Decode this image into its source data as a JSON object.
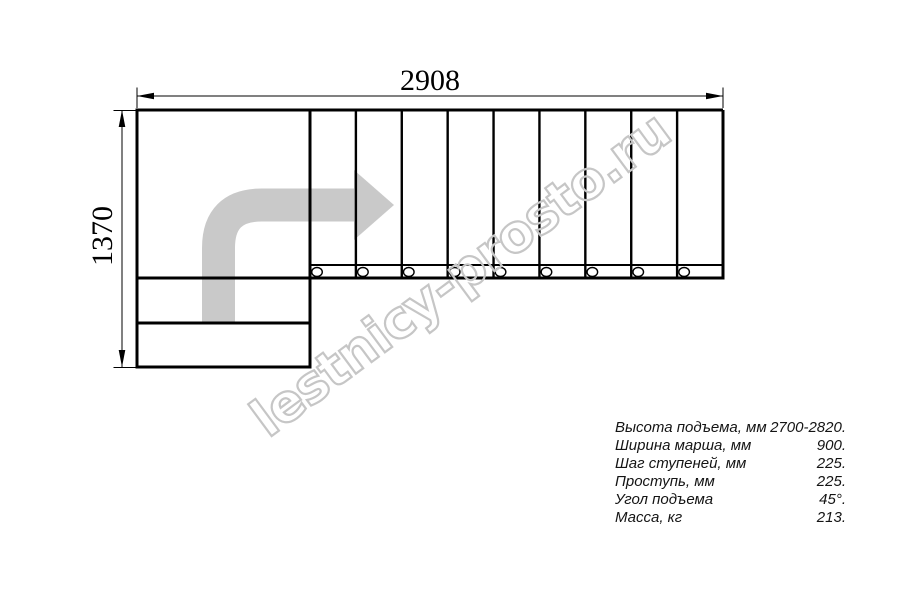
{
  "drawing": {
    "dimensions": {
      "width_label": "2908",
      "height_label": "1370"
    },
    "plan": {
      "right_flight_treads": 9,
      "landing_lower_steps": 2,
      "mount_holes": 9,
      "line_color": "#000000"
    },
    "arrow": {
      "name": "stair-direction-arrow",
      "color": "#c9c9c9"
    }
  },
  "watermark": {
    "text": "lestnicy-prosto.ru",
    "color": "#c6c6c6"
  },
  "specs": {
    "rows": [
      {
        "label": "Высота подъема, мм",
        "value": "2700-2820."
      },
      {
        "label": "Ширина марша, мм",
        "value": "900."
      },
      {
        "label": "Шаг ступеней, мм",
        "value": "225."
      },
      {
        "label": "Проступь, мм",
        "value": "225."
      },
      {
        "label": "Угол подъема",
        "value": "45°."
      },
      {
        "label": "Масса, кг",
        "value": "213."
      }
    ]
  }
}
